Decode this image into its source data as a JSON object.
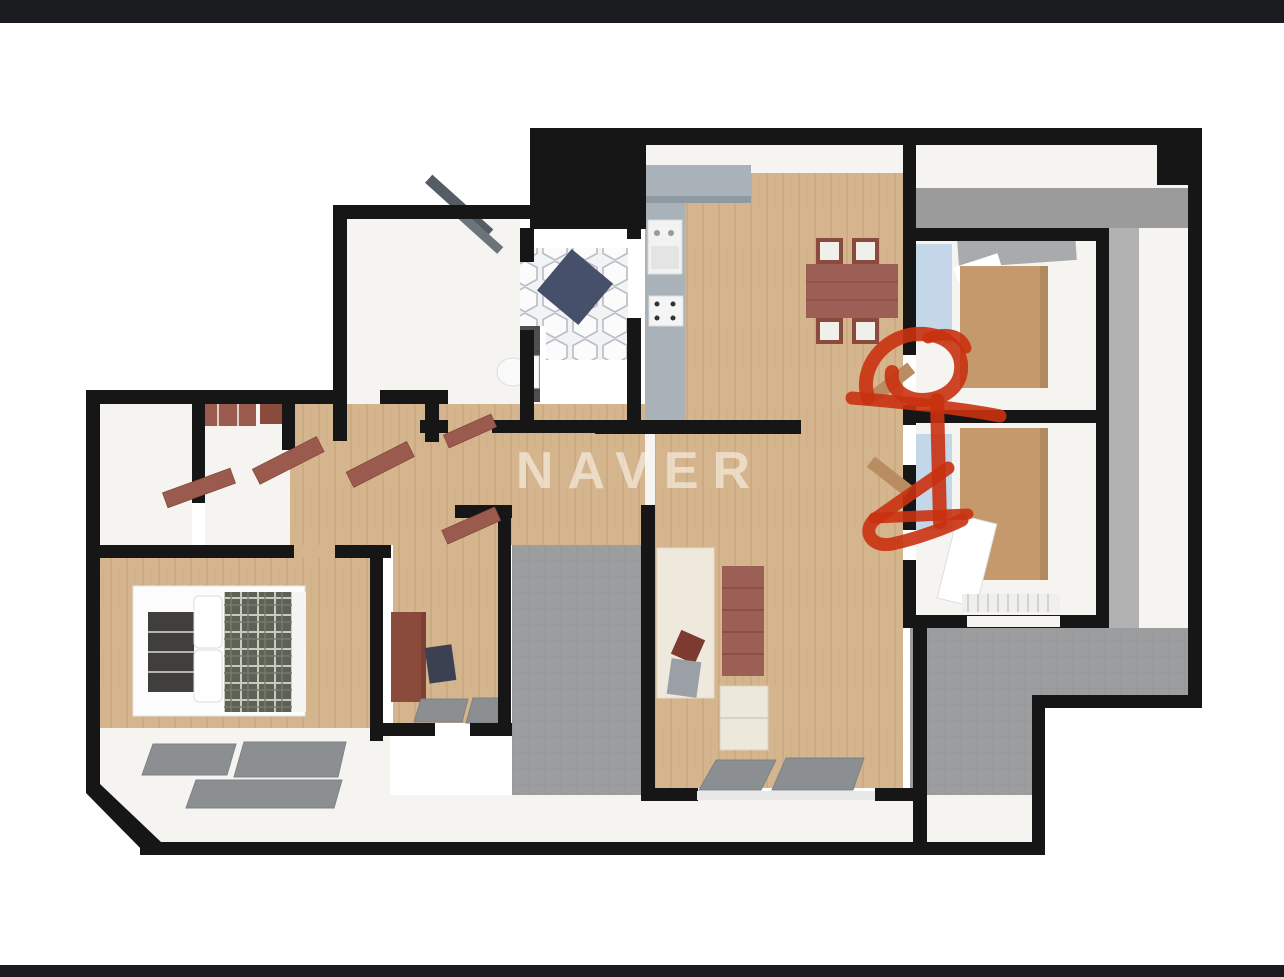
{
  "watermark": {
    "text": "NAVER"
  },
  "chrome": {
    "top_bar": "letterbox-black-bar",
    "bottom_bar": "letterbox-black-bar"
  },
  "palette": {
    "bg": "#ffffff",
    "barColor": "#1a1b1f",
    "wall": "#161616",
    "floorWhite": "#f5f4f1",
    "wood": "#d5b58e",
    "woodWardrobe": "#c49a6c",
    "grayTile": "#9c9d9e",
    "grayMat": "#8b8f92",
    "grayWallTop": "#9b9b9b",
    "bathTile": "#4f4f4f",
    "counter": "#a9b2b9",
    "counterEdge": "#8f99a1",
    "furnRed": "#9a5a4e",
    "furnRedDark": "#8a4a3c",
    "tableRed": "#9c5f55",
    "navy": "#46506a",
    "glass": "#c3d7e9",
    "hexLine": "#b9bdc4",
    "blanket": "#5d6156",
    "blanketLine": "#c8cabe",
    "rug": "#efe9dd",
    "marker": "#c93110",
    "watermarkColor": "rgba(255,252,244,0.55)"
  },
  "floorplan": {
    "type": "3d-apartment-floorplan-render",
    "rooms": [
      {
        "name": "entry-hall-hex-tile"
      },
      {
        "name": "entry-bathroom"
      },
      {
        "name": "kitchen-dining"
      },
      {
        "name": "hallway"
      },
      {
        "name": "closet-room-left"
      },
      {
        "name": "closet-room-middle"
      },
      {
        "name": "master-bedroom"
      },
      {
        "name": "study-room"
      },
      {
        "name": "living-room"
      },
      {
        "name": "bedroom-right-upper"
      },
      {
        "name": "bedroom-right-lower"
      },
      {
        "name": "balcony-utility-gray"
      }
    ],
    "furniture": [
      "front-door-open",
      "shoe-cabinet",
      "toilet",
      "kitchen-counter-L",
      "stove",
      "burner-panel",
      "dining-table",
      "dining-chairs-x4",
      "sofa",
      "area-rug",
      "cushion",
      "side-table",
      "balcony-floor-mats",
      "double-bed",
      "plaid-blanket",
      "pillows",
      "headboard-bench",
      "desk",
      "desk-chair",
      "wardrobe-panels",
      "open-door-leaves",
      "window-glass-bands"
    ]
  },
  "annotations": {
    "color": "#c93110",
    "marks": [
      "red-scribble-upper",
      "red-scribble-lower"
    ]
  }
}
